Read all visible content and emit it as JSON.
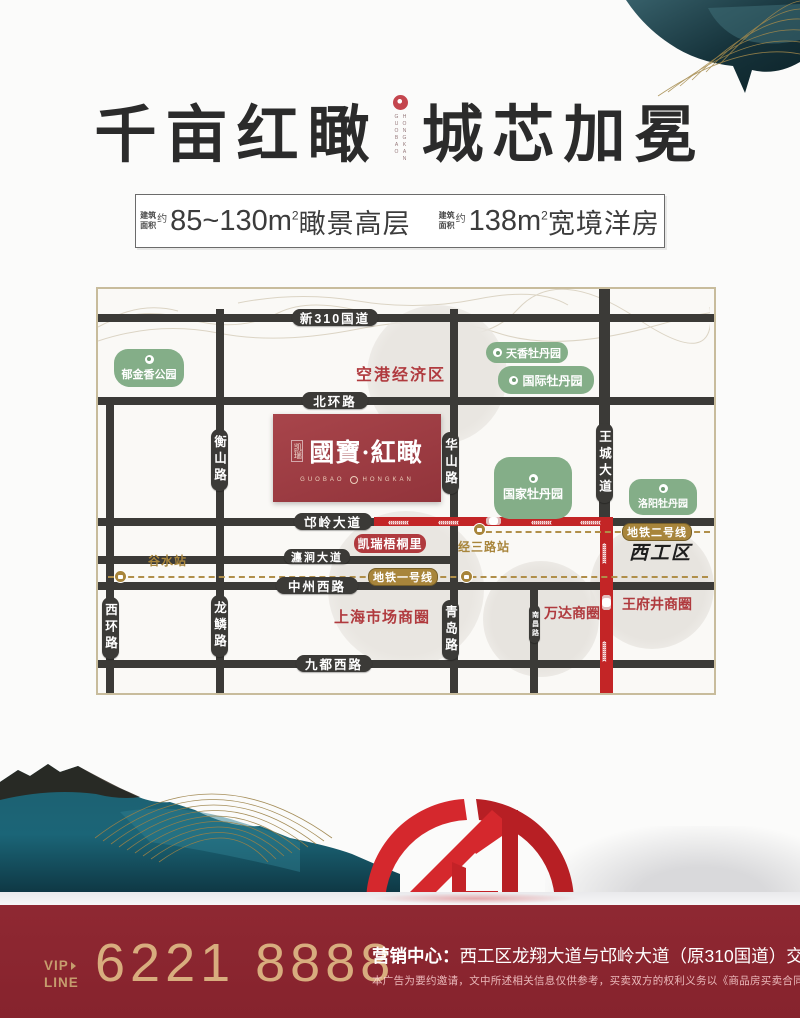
{
  "header": {
    "title_left": "千亩红瞰",
    "title_right": "城芯加冕",
    "logo_latin_1": "GUOBAO",
    "logo_latin_2": "HONGKAN"
  },
  "specs": {
    "area_word_1": "建筑",
    "area_word_2": "面积",
    "approx": "约",
    "item1_value": "85~130m",
    "item1_sup": "2",
    "item1_suffix": "瞰景高层",
    "item2_value": "138m",
    "item2_sup": "2",
    "item2_suffix": "宽境洋房"
  },
  "map": {
    "roads": {
      "g310": "新310国道",
      "beihuan": "北环路",
      "mangling": "邙岭大道",
      "chanjian": "瀍涧大道",
      "zhongzhou": "中州西路",
      "jiudu": "九都西路",
      "hengshan": "衡山路",
      "xihuan": "西环路",
      "longlin": "龙鳞路",
      "huashan": "华山路",
      "qingdao": "青岛路",
      "wangcheng": "王城大道",
      "nanchang": "南昌路"
    },
    "metro": {
      "line1": "地铁一号线",
      "line2": "地铁二号线",
      "station_gushui": "谷水站",
      "station_jingsan": "经三路站"
    },
    "green_pois": {
      "yujinxiang": "郁金香公园",
      "tianxiang": "天香牡丹园",
      "guoji": "国际牡丹园",
      "guojia": "国家牡丹园",
      "luoyang": "洛阳牡丹园"
    },
    "red_areas": {
      "konggang": "空港经济区",
      "shanghai": "上海市场商圈",
      "wanda": "万达商圈",
      "wangfujing": "王府井商圈",
      "wutongli": "凯瑞梧桐里"
    },
    "district": "西工区",
    "project": {
      "prefix": "凯瑞",
      "name": "國寶·紅瞰",
      "latin_left": "GUOBAO",
      "latin_right": "HONGKAN"
    }
  },
  "footer": {
    "vip_word1": "VIP",
    "vip_word2": "LINE",
    "phone": "6221 8888",
    "office_label": "营销中心：",
    "office_text": "西工区龙翔大道与邙岭大道（原310国道）交会处",
    "disclaimer": "本广告为要约邀请，文中所述相关信息仅供参考，买卖双方的权利义务以《商品房买卖合同》为准。"
  },
  "colors": {
    "footer_bg": "#8d2731",
    "gold": "#c99f6d",
    "metro_gold": "#a8853b",
    "road_dark": "#3b3a37",
    "road_red": "#c32526",
    "poi_green": "#84ae88",
    "accent_red_text": "#b03a3e",
    "project_red": "#9d3c41",
    "sculpture_red": "#d2262b",
    "ink_teal": "#1d5d6d"
  }
}
